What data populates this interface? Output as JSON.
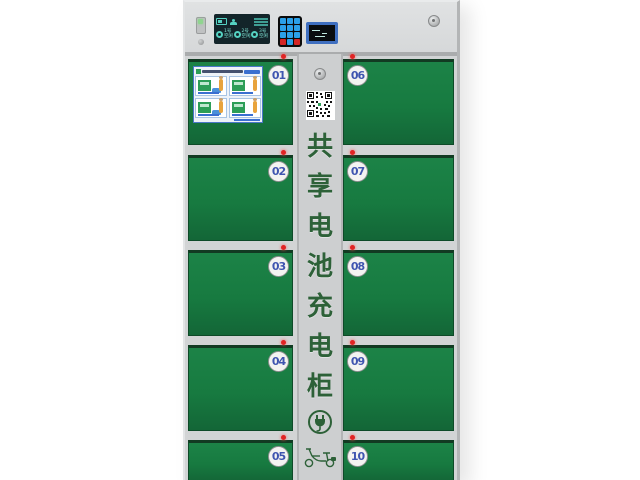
{
  "scene": {
    "description": "3D product render of a shared e-bike battery charging cabinet on white background",
    "background_color": "#ffffff"
  },
  "cabinet": {
    "vertical_title": "共享电池充电柜",
    "vertical_title_chars": [
      "共",
      "享",
      "电",
      "池",
      "充",
      "电",
      "柜"
    ],
    "colors": {
      "door_green": "#177a40",
      "cabinet_gray": "#d2d4d5",
      "center_strip_gray": "#cdcfd0",
      "badge_number_blue": "#3f55b0",
      "indicator_led_red": "#e02424",
      "title_text_green": "#2d6138",
      "keypad_key_blue": "#2ba0e8",
      "keypad_key_red": "#d42525",
      "status_screen_teal": "#55d2c2",
      "display_frame_blue": "#3f6fc0",
      "sticker_border_blue": "#4a77c8"
    },
    "top_panel": {
      "status_screen_gauges": [
        {
          "line1": "1号",
          "line2": "空闲"
        },
        {
          "line1": "2号",
          "line2": "空闲"
        },
        {
          "line1": "3号",
          "line2": "空闲"
        }
      ],
      "keypad": {
        "rows": 4,
        "cols": 3
      }
    },
    "doors": [
      {
        "number": "01",
        "column": "left"
      },
      {
        "number": "02",
        "column": "left"
      },
      {
        "number": "03",
        "column": "left"
      },
      {
        "number": "04",
        "column": "left"
      },
      {
        "number": "05",
        "column": "left"
      },
      {
        "number": "06",
        "column": "right"
      },
      {
        "number": "07",
        "column": "right"
      },
      {
        "number": "08",
        "column": "right"
      },
      {
        "number": "09",
        "column": "right"
      },
      {
        "number": "10",
        "column": "right"
      }
    ],
    "instruction_sticker": {
      "on_door": "01",
      "step_tiles": 4
    },
    "icons": {
      "qr": "qr-code-icon",
      "plug": "power-plug-icon",
      "scooter": "e-bike-icon",
      "lock": "lock-knob-icon",
      "door_led": "status-led-icon"
    }
  }
}
